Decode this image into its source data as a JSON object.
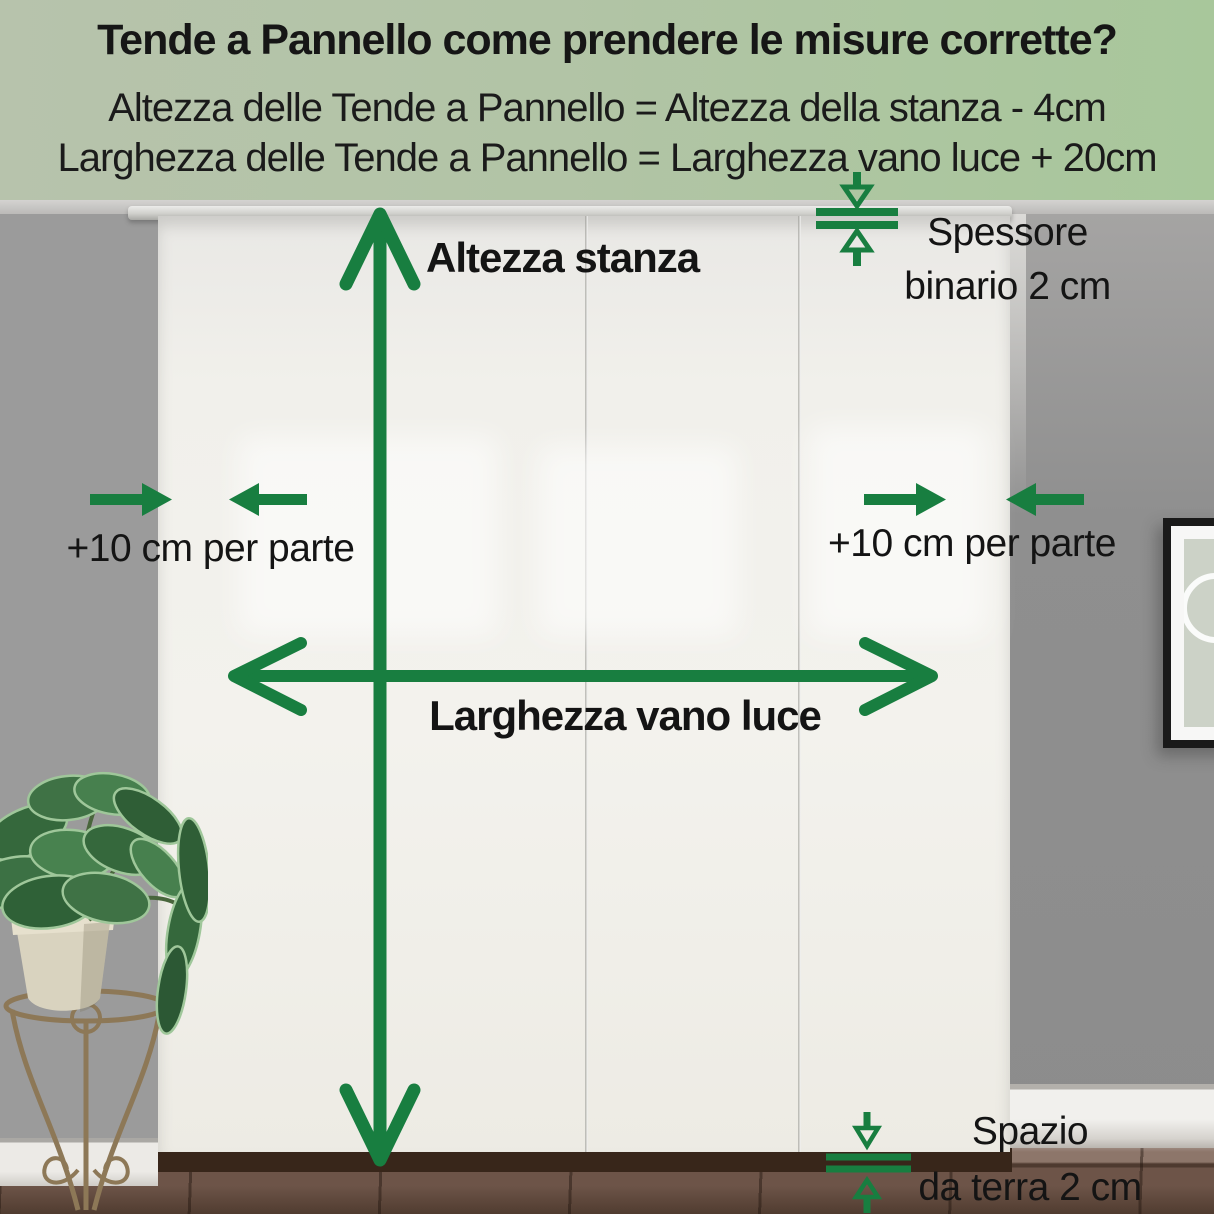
{
  "header": {
    "title": "Tende a Pannello come prendere le misure corrette?",
    "formula_height": "Altezza delle Tende a Pannello = Altezza della stanza - 4cm",
    "formula_width": "Larghezza delle Tende a Pannello = Larghezza vano luce + 20cm"
  },
  "labels": {
    "room_height": "Altezza stanza",
    "rail_thickness_line1": "Spessore",
    "rail_thickness_line2": "binario 2 cm",
    "side_margin_left": "+10 cm per parte",
    "side_margin_right": "+10 cm per parte",
    "opening_width": "Larghezza vano luce",
    "floor_gap_line1": "Spazio",
    "floor_gap_line2": "da terra 2 cm"
  },
  "colors": {
    "accent_green": "#187e40",
    "header_gradient_left": "#b7c3ac",
    "header_gradient_right": "#a8c79b",
    "label_text": "#141414",
    "wall_gray": "#9b9b9b",
    "curtain_white": "#f1f0eb",
    "floor_brown": "#6d5448"
  }
}
